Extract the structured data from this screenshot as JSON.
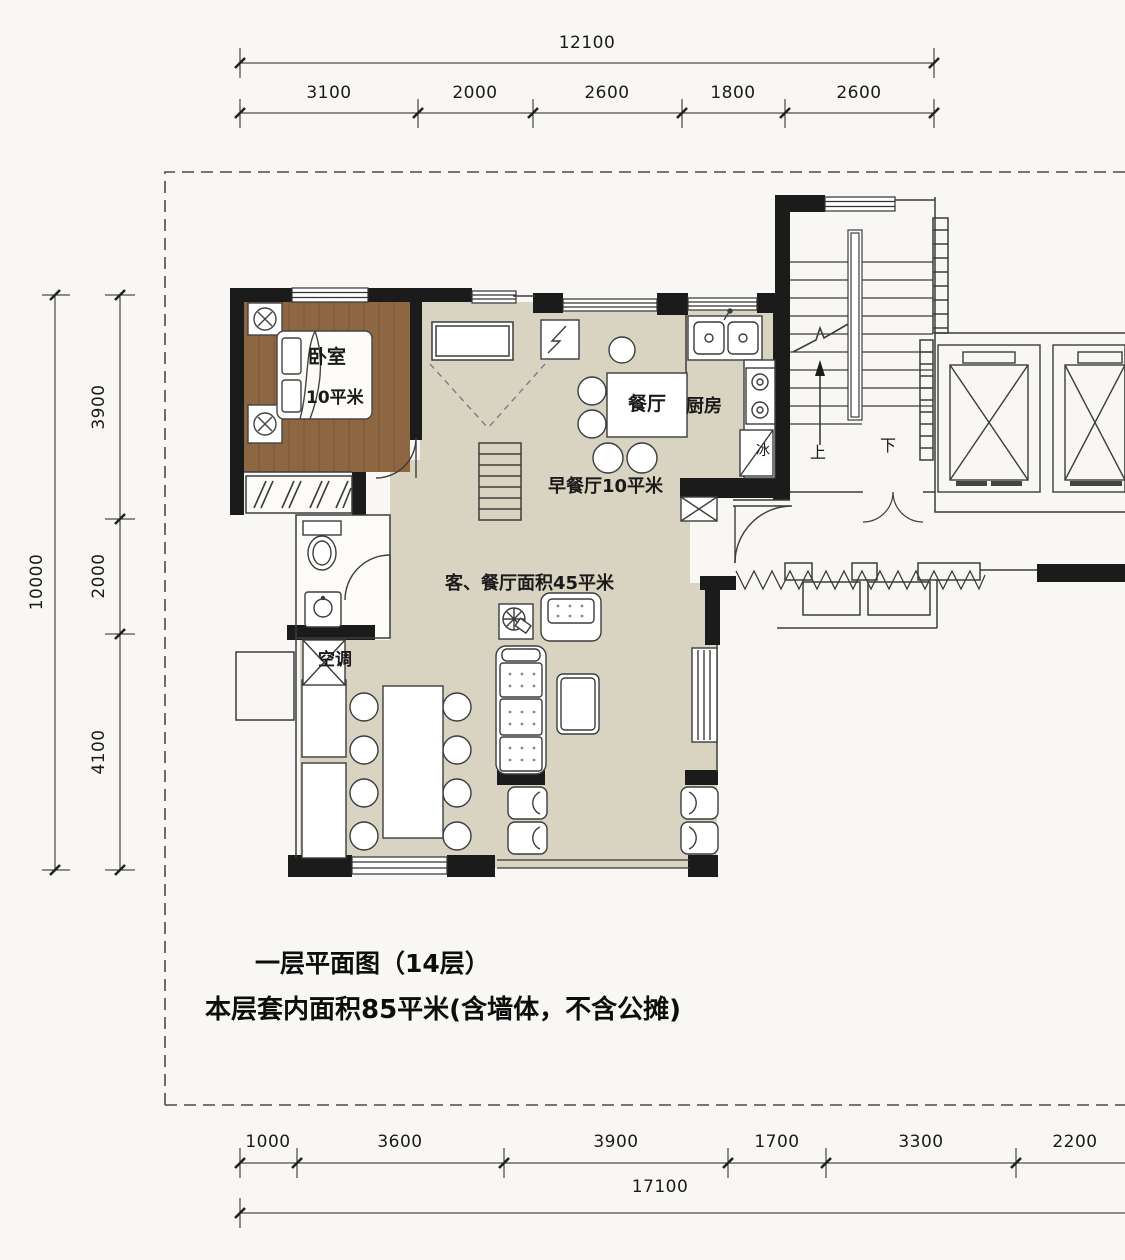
{
  "title": {
    "line1": "一层平面图（14层）",
    "line2": "本层套内面积85平米(含墙体，不含公摊)"
  },
  "dimensions": {
    "top": {
      "total": "12100",
      "segments": [
        "3100",
        "2000",
        "2600",
        "1800",
        "2600"
      ]
    },
    "left": {
      "total": "10000",
      "segments": [
        "3900",
        "2000",
        "4100"
      ]
    },
    "bottom": {
      "total": "17100",
      "segments": [
        "1000",
        "3600",
        "3900",
        "1700",
        "3300",
        "2200"
      ]
    }
  },
  "labels": {
    "bedroom": "卧室",
    "bedroom_area": "10平米",
    "dining": "餐厅",
    "kitchen": "厨房",
    "breakfast": "早餐厅10平米",
    "living_dining": "客、餐厅面积45平米",
    "air_conditioner": "空调",
    "fridge": "冰",
    "stairs_up": "上",
    "stairs_down": "下"
  },
  "colors": {
    "wall": "#1b1b1b",
    "wood_floor": "#8d6741",
    "tile_floor": "#d8d4c1",
    "line": "#3c3c3c",
    "paper": "#f8f7f4"
  }
}
